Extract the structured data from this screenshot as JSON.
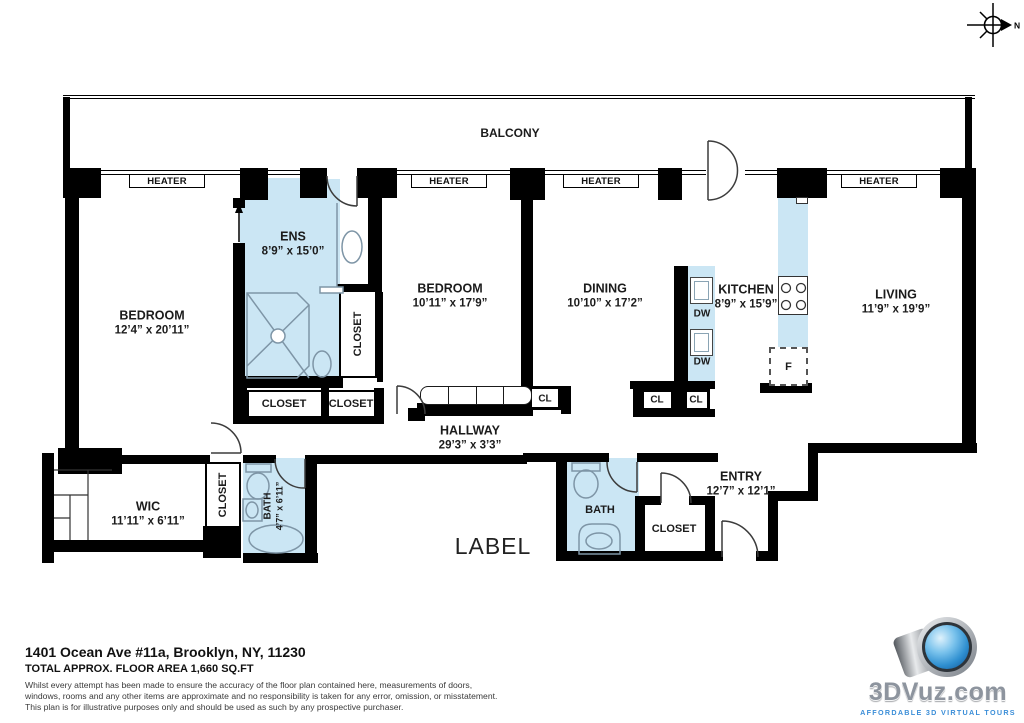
{
  "compass": {
    "north": "N"
  },
  "rooms": {
    "balcony": {
      "name": "BALCONY"
    },
    "bedroom1": {
      "name": "BEDROOM",
      "dims": "12’4” x 20’11”"
    },
    "ens": {
      "name": "ENS",
      "dims": "8’9” x 15’0”"
    },
    "bedroom2": {
      "name": "BEDROOM",
      "dims": "10’11” x 17’9”"
    },
    "dining": {
      "name": "DINING",
      "dims": "10’10” x 17’2”"
    },
    "kitchen": {
      "name": "KITCHEN",
      "dims": "8’9” x 15’9”"
    },
    "living": {
      "name": "LIVING",
      "dims": "11’9” x 19’9”"
    },
    "hallway": {
      "name": "HALLWAY",
      "dims": "29’3” x 3’3”"
    },
    "wic": {
      "name": "WIC",
      "dims": "11’11” x 6’11”"
    },
    "bath1": {
      "name": "BATH",
      "dims": "4’7” x 6’11”"
    },
    "bath2": {
      "name": "BATH"
    },
    "entry": {
      "name": "ENTRY",
      "dims": "12’7” x 12’1”"
    }
  },
  "closets": {
    "ens_side": "CLOSET",
    "below_ens_a": "CLOSET",
    "below_ens_b": "CLOSET",
    "wic_side": "CLOSET",
    "entry": "CLOSET",
    "hall_cl": "CL",
    "kitchen_cl_a": "CL",
    "kitchen_cl_b": "CL"
  },
  "appliances": {
    "dw_a": "DW",
    "dw_b": "DW",
    "fridge": "F"
  },
  "heaters": {
    "labels": [
      "HEATER",
      "HEATER",
      "HEATER",
      "HEATER"
    ]
  },
  "placeholder": {
    "text": "LABEL"
  },
  "footer": {
    "address": "1401 Ocean Ave #11a, Brooklyn, NY, 11230",
    "area": "TOTAL APPROX. FLOOR AREA 1,660 SQ.FT",
    "disclaimer_line1": "Whilst every attempt has been made to ensure the accuracy of the floor plan contained here, measurements of doors,",
    "disclaimer_line2": "windows, rooms and any other items are approximate and no responsibility is taken for any error, omission, or misstatement.",
    "disclaimer_line3": "This plan is for illustrative purposes only and should be used as such by any prospective purchaser."
  },
  "logo": {
    "brand": "3DVuz",
    "suffix": ".com",
    "tagline": "AFFORDABLE 3D VIRTUAL TOURS"
  },
  "colors": {
    "wall": "#000000",
    "wet_area": "#cbe6f4",
    "fixture_stroke": "#7e95a6",
    "logo_blue": "#3b8ed8"
  }
}
